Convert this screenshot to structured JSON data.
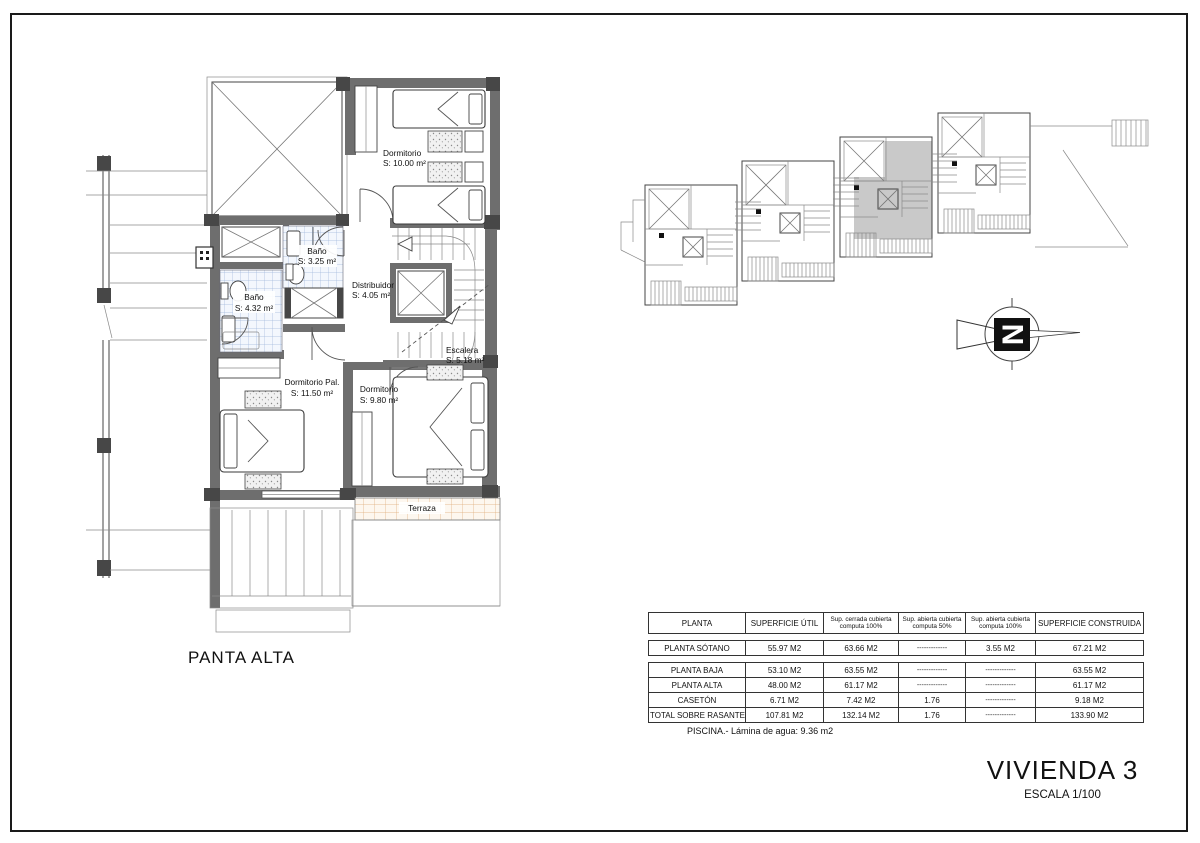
{
  "drawing": {
    "floor_label": "PANTA ALTA",
    "title": "VIVIENDA 3",
    "scale": "ESCALA 1/100",
    "pool_note": "PISCINA.- Lámina de agua: 9.36 m2",
    "compass_letter": "N"
  },
  "rooms": {
    "dorm_top": {
      "name": "Dormitorio",
      "area": "S: 10.00 m²"
    },
    "bano_small": {
      "name": "Baño",
      "area": "S: 3.25 m²"
    },
    "bano_large": {
      "name": "Baño",
      "area": "S: 4.32 m²"
    },
    "distribuidor": {
      "name": "Distribuidor",
      "area": "S: 4.05 m²"
    },
    "escalera": {
      "name": "Escalera",
      "area": "S: 5.18 m²"
    },
    "dorm_pal": {
      "name": "Dormitorio Pal.",
      "area": "S: 11.50 m²"
    },
    "dorm_right": {
      "name": "Dormitorio",
      "area": "S: 9.80 m²"
    },
    "terraza": {
      "name": "Terraza"
    }
  },
  "area_table": {
    "headers": [
      "PLANTA",
      "SUPERFICIE ÚTIL",
      "Sup. cerrada cubierta computa 100%",
      "Sup. abierta cubierta computa 50%",
      "Sup. abierta cubierta computa 100%",
      "SUPERFICIE CONSTRUIDA"
    ],
    "rows": [
      {
        "cells": [
          "PLANTA SÓTANO",
          "55.97 M2",
          "63.66 M2",
          "-------------",
          "3.55 M2",
          "67.21 M2"
        ]
      },
      {
        "cells": [
          "PLANTA BAJA",
          "53.10 M2",
          "63.55 M2",
          "-------------",
          "-------------",
          "63.55 M2"
        ]
      },
      {
        "cells": [
          "PLANTA ALTA",
          "48.00 M2",
          "61.17 M2",
          "-------------",
          "-------------",
          "61.17 M2"
        ]
      },
      {
        "cells": [
          "CASETÓN",
          "6.71 M2",
          "7.42 M2",
          "1.76",
          "-------------",
          "9.18 M2"
        ]
      },
      {
        "cells": [
          "TOTAL SOBRE RASANTE",
          "107.81 M2",
          "132.14 M2",
          "1.76",
          "-------------",
          "133.90 M2"
        ]
      }
    ]
  },
  "colors": {
    "wall": "#6e6e6e",
    "pillar": "#474747",
    "tile_blue": "#9fb8dc",
    "tile_orange": "#ddab77",
    "key_plan_highlight": "#c9c9c9",
    "line": "#444"
  }
}
